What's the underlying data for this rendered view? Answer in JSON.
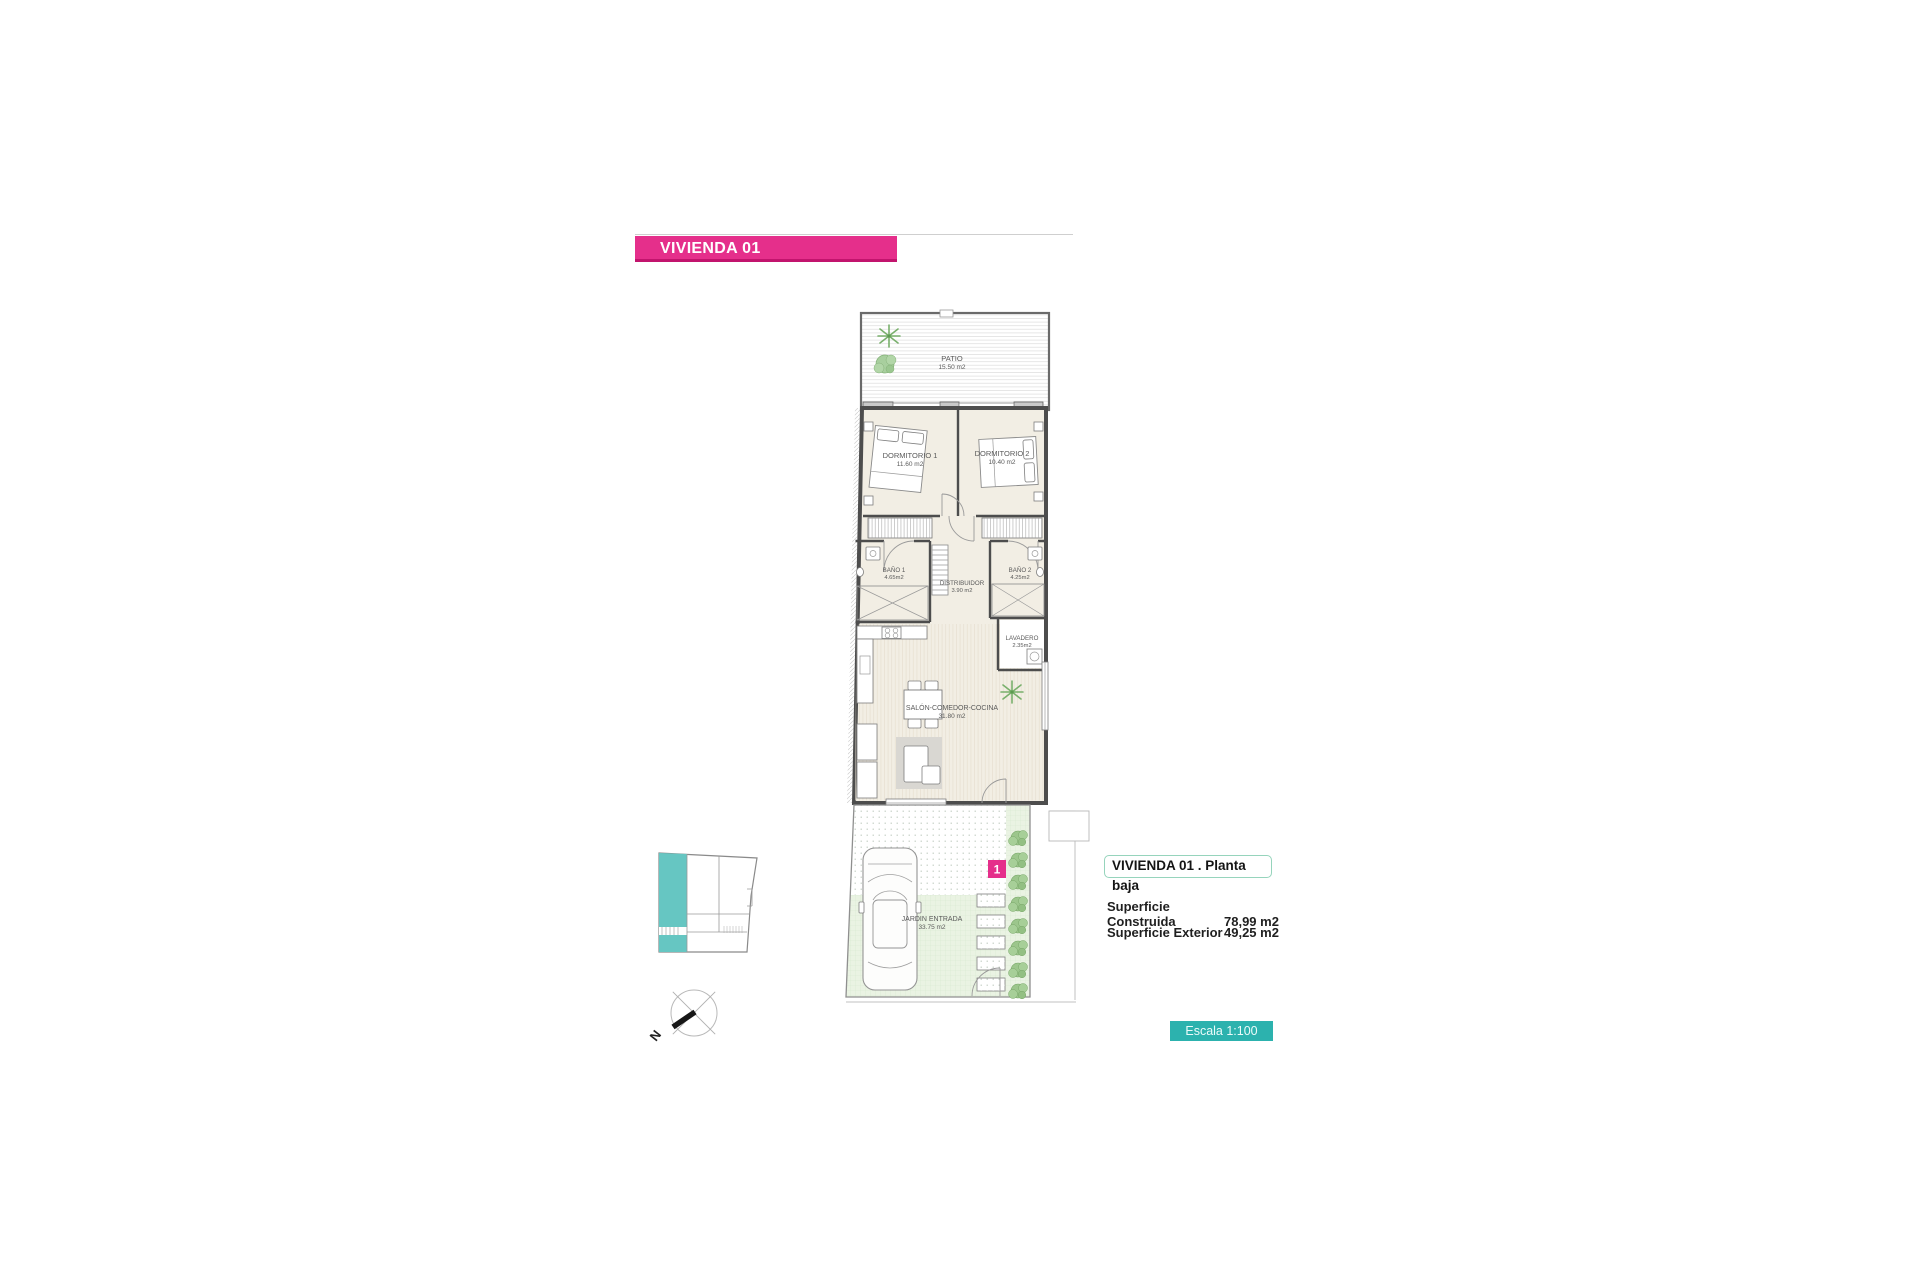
{
  "page": {
    "banner": "VIVIENDA 01"
  },
  "plan": {
    "rooms": [
      {
        "name": "PATIO",
        "area": "15.50 m2"
      },
      {
        "name": "DORMITORIO 1",
        "area": "11.60 m2"
      },
      {
        "name": "DORMITORIO 2",
        "area": "10.40 m2"
      },
      {
        "name": "BAÑO 1",
        "area": "4.65m2"
      },
      {
        "name": "DISTRIBUIDOR",
        "area": "3.90 m2"
      },
      {
        "name": "BAÑO 2",
        "area": "4.25m2"
      },
      {
        "name": "LAVADERO",
        "area": "2.35m2"
      },
      {
        "name": "SALÓN-COMEDOR-COCINA",
        "area": "31.80 m2"
      },
      {
        "name": "JARDIN ENTRADA",
        "area": "33.75 m2"
      }
    ],
    "unit_badge": "1",
    "compass_label": "N"
  },
  "legend": {
    "title": "VIVIENDA 01 .  Planta baja",
    "rows": [
      {
        "label": "Superficie Construida",
        "value": "78,99 m2"
      },
      {
        "label": "Superficie Exterior",
        "value": "49,25 m2"
      }
    ]
  },
  "scale_box": {
    "label": "Escala 1:100"
  },
  "colors": {
    "pink": "#e52f8b",
    "teal": "#2cb2ae",
    "keyplan_teal": "#66c6c2",
    "legend_border": "#96d4bc",
    "floor": "#f2eee4",
    "garden": "#eaf3e3",
    "wall": "#4d4d4d",
    "plant_green": "#8cc07e"
  }
}
